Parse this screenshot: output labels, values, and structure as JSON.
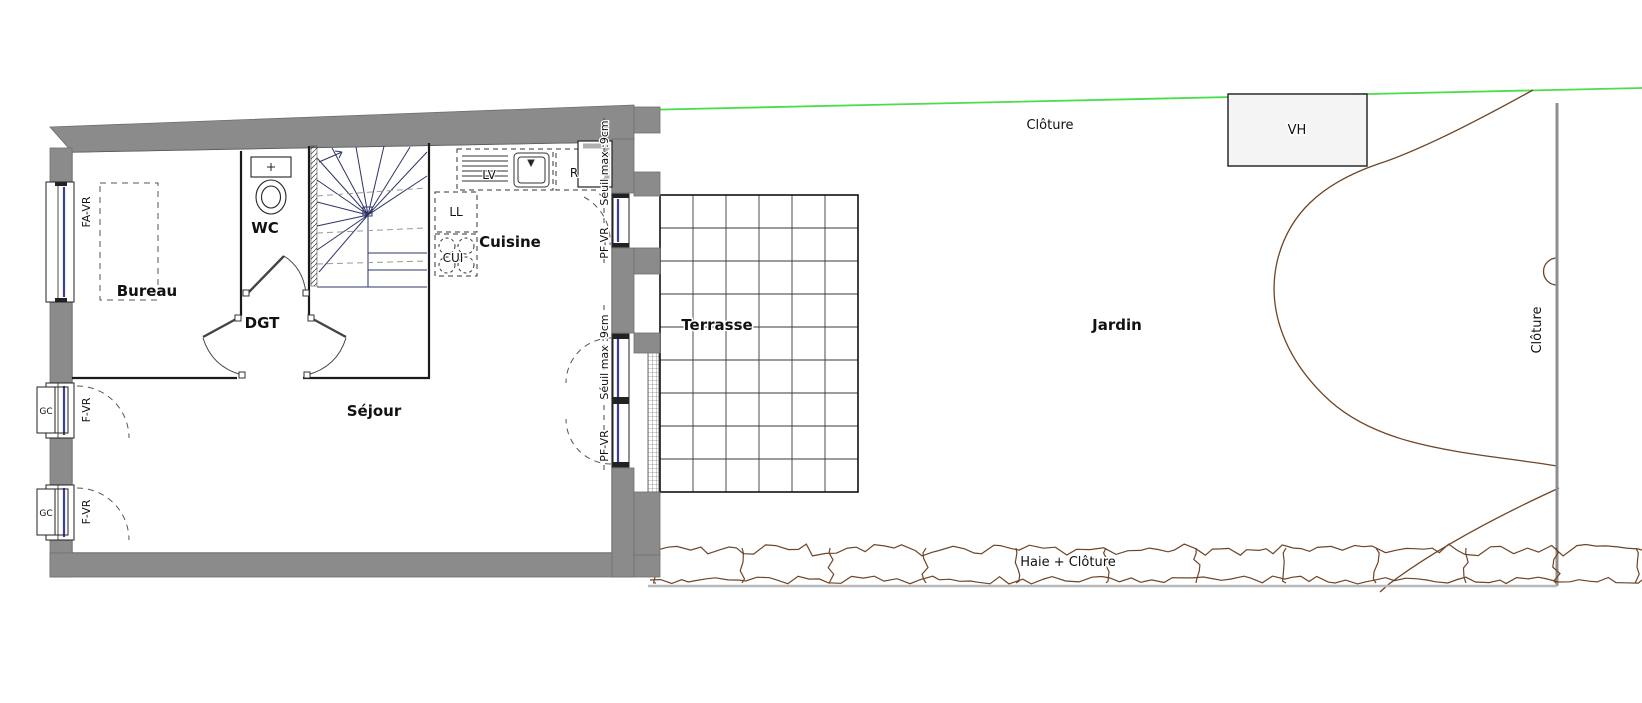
{
  "plan": {
    "rooms": {
      "bureau": "Bureau",
      "wc": "WC",
      "dgt": "DGT",
      "sejour": "Séjour",
      "cuisine": "Cuisine",
      "terrasse": "Terrasse",
      "jardin": "Jardin"
    },
    "openings": {
      "fa_vr": "FA-VR",
      "f_vr_upper": "F-VR",
      "f_vr_lower": "F-VR",
      "gc_upper": "GC",
      "gc_lower": "GC",
      "pf_vr_kitchen": "PF-VR",
      "seuil_kitchen": "Séuil max :9cm",
      "pf_vr_sejour": "PF-VR",
      "seuil_sejour": "Séuil max :9cm"
    },
    "appliances": {
      "dishwasher": "LV",
      "fridge": "R",
      "washer": "LL",
      "cooker": "CUI"
    },
    "site": {
      "fence_top": "Clôture",
      "fence_right": "Clôture",
      "vh": "VH",
      "hedge": "Haie + Clôture"
    },
    "colors": {
      "wall": "#8b8b8b",
      "stair": "#2e3566",
      "glazing": "#3a3f9e",
      "boundary_green": "#4ade4a",
      "garden_brown": "#6e4527",
      "fence_gray": "#8f8f8f"
    }
  }
}
